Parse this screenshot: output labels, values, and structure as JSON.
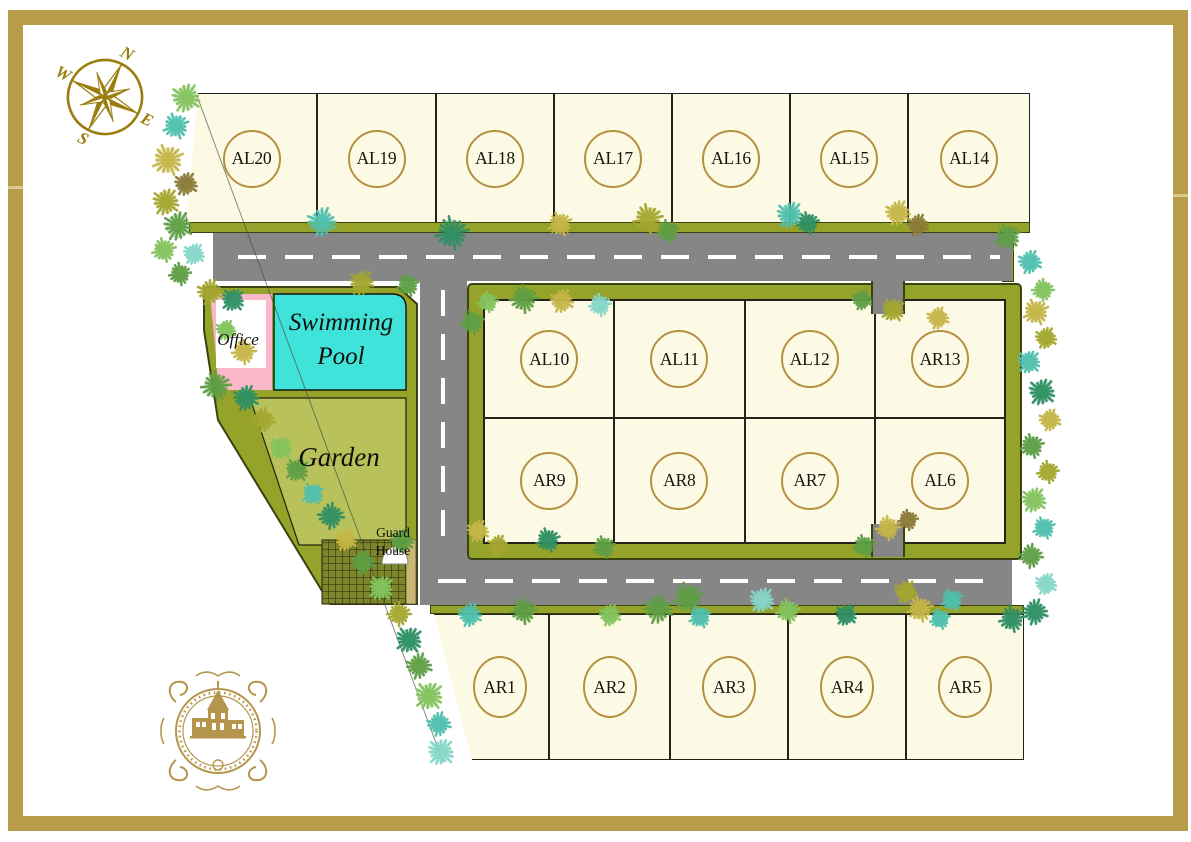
{
  "title": "Residential estate subdivision site plan",
  "compass": {
    "n": "N",
    "e": "E",
    "s": "S",
    "w": "W"
  },
  "lots_top": [
    "AL20",
    "AL19",
    "AL18",
    "AL17",
    "AL16",
    "AL15",
    "AL14"
  ],
  "lots_mid_top": [
    "AL10",
    "AL11",
    "AL12",
    "AR13"
  ],
  "lots_mid_bottom": [
    "AR9",
    "AR8",
    "AR7",
    "AL6"
  ],
  "lots_bottom": [
    "AR1",
    "AR2",
    "AR3",
    "AR4",
    "AR5"
  ],
  "amenities": {
    "office": "Office",
    "pool": "Swimming Pool",
    "garden": "Garden",
    "guard_house": "Guard House"
  },
  "colors": {
    "frame_gold": "#B99C4A",
    "compass_gold": "#9A7D0E",
    "logo_gold": "#B5954B",
    "lot_fill": "#FCFAE4",
    "lot_border": "#23231A",
    "badge_ring": "#B49141",
    "road_gray": "#868686",
    "road_dash": "#FFFFFF",
    "green_band": "#95A32B",
    "band_border": "#39430F",
    "garden_green": "#B9C25A",
    "pool_cyan": "#3FE3DA",
    "office_pink": "#F9B7C9",
    "guard_hatch": "#7D8628"
  },
  "trees": {
    "palette": [
      "#5E9E44",
      "#83C35D",
      "#2E8F63",
      "#4FC0AE",
      "#85D6C8",
      "#A3A62E",
      "#C4B547",
      "#7D8A26",
      "#8A7A38"
    ],
    "items": [
      [
        186,
        98,
        15,
        1
      ],
      [
        176,
        126,
        13,
        3
      ],
      [
        168,
        160,
        16,
        6
      ],
      [
        186,
        184,
        12,
        8
      ],
      [
        166,
        202,
        14,
        5
      ],
      [
        178,
        226,
        15,
        0
      ],
      [
        164,
        250,
        12,
        1
      ],
      [
        194,
        254,
        11,
        4
      ],
      [
        180,
        274,
        11,
        0
      ],
      [
        210,
        292,
        13,
        5
      ],
      [
        233,
        300,
        12,
        2
      ],
      [
        226,
        330,
        10,
        1
      ],
      [
        244,
        352,
        12,
        6
      ],
      [
        216,
        386,
        15,
        0
      ],
      [
        246,
        398,
        13,
        2
      ],
      [
        263,
        420,
        12,
        5
      ],
      [
        281,
        448,
        12,
        1
      ],
      [
        297,
        470,
        12,
        0
      ],
      [
        313,
        494,
        11,
        3
      ],
      [
        331,
        516,
        13,
        2
      ],
      [
        346,
        540,
        11,
        6
      ],
      [
        363,
        562,
        12,
        0
      ],
      [
        381,
        588,
        13,
        1
      ],
      [
        399,
        614,
        12,
        5
      ],
      [
        409,
        640,
        14,
        2
      ],
      [
        419,
        666,
        13,
        0
      ],
      [
        429,
        696,
        15,
        1
      ],
      [
        439,
        724,
        12,
        3
      ],
      [
        441,
        752,
        14,
        4
      ],
      [
        322,
        222,
        15,
        3
      ],
      [
        452,
        233,
        17,
        2
      ],
      [
        560,
        224,
        12,
        6
      ],
      [
        648,
        219,
        15,
        5
      ],
      [
        668,
        231,
        11,
        0
      ],
      [
        790,
        215,
        14,
        3
      ],
      [
        808,
        223,
        11,
        2
      ],
      [
        898,
        213,
        13,
        6
      ],
      [
        918,
        225,
        11,
        8
      ],
      [
        1008,
        237,
        13,
        0
      ],
      [
        1030,
        262,
        12,
        3
      ],
      [
        1043,
        290,
        11,
        1
      ],
      [
        362,
        283,
        13,
        5
      ],
      [
        408,
        285,
        11,
        0
      ],
      [
        524,
        299,
        14,
        0
      ],
      [
        562,
        301,
        12,
        6
      ],
      [
        600,
        305,
        11,
        4
      ],
      [
        1036,
        312,
        13,
        6
      ],
      [
        1046,
        338,
        11,
        5
      ],
      [
        1029,
        362,
        12,
        3
      ],
      [
        1042,
        392,
        14,
        2
      ],
      [
        1050,
        420,
        11,
        6
      ],
      [
        1032,
        446,
        12,
        0
      ],
      [
        1048,
        472,
        11,
        5
      ],
      [
        1034,
        500,
        13,
        1
      ],
      [
        1044,
        528,
        11,
        3
      ],
      [
        1031,
        556,
        12,
        0
      ],
      [
        1046,
        584,
        11,
        4
      ],
      [
        1035,
        612,
        13,
        2
      ],
      [
        893,
        310,
        12,
        5
      ],
      [
        938,
        318,
        11,
        6
      ],
      [
        862,
        300,
        10,
        0
      ],
      [
        888,
        528,
        12,
        6
      ],
      [
        864,
        546,
        11,
        0
      ],
      [
        908,
        520,
        10,
        8
      ],
      [
        498,
        546,
        11,
        5
      ],
      [
        548,
        540,
        12,
        2
      ],
      [
        604,
        547,
        11,
        0
      ],
      [
        688,
        598,
        16,
        0
      ],
      [
        762,
        600,
        13,
        4
      ],
      [
        906,
        592,
        12,
        5
      ],
      [
        952,
        600,
        11,
        3
      ],
      [
        470,
        615,
        12,
        3
      ],
      [
        524,
        611,
        13,
        0
      ],
      [
        610,
        615,
        11,
        1
      ],
      [
        658,
        609,
        15,
        0
      ],
      [
        700,
        617,
        11,
        3
      ],
      [
        788,
        611,
        12,
        1
      ],
      [
        846,
        615,
        11,
        2
      ],
      [
        920,
        609,
        13,
        6
      ],
      [
        940,
        619,
        10,
        3
      ],
      [
        1012,
        619,
        13,
        2
      ],
      [
        472,
        322,
        12,
        0
      ],
      [
        488,
        302,
        10,
        1
      ],
      [
        478,
        531,
        11,
        6
      ],
      [
        402,
        541,
        12,
        0
      ]
    ]
  }
}
